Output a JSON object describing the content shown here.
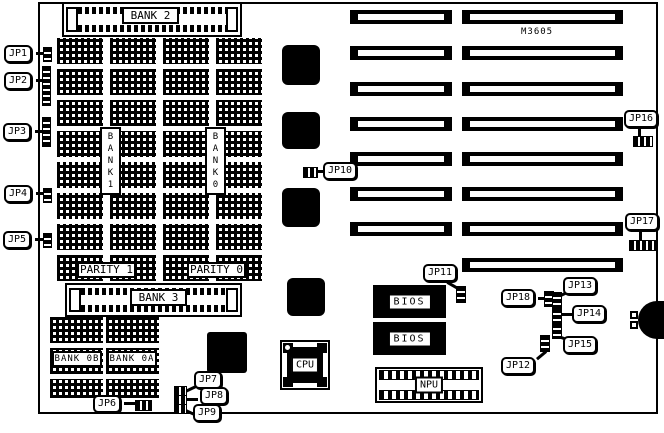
{
  "diagram": {
    "model": "M3605",
    "cpu": "CPU",
    "npu": "NPU",
    "bios_top": "BIOS",
    "bios_bottom": "BIOS",
    "bank2": "BANK 2",
    "bank3": "BANK 3",
    "bank1_vertical": "B\nA\nN\nK\n1",
    "bank0_vertical": "B\nA\nN\nK\n0",
    "parity1": "PARITY 1",
    "parity0": "PARITY 0",
    "bank0b": "BANK 0B",
    "bank0a": "BANK 0A",
    "jp1": "JP1",
    "jp2": "JP2",
    "jp3": "JP3",
    "jp4": "JP4",
    "jp5": "JP5",
    "jp6": "JP6",
    "jp7": "JP7",
    "jp8": "JP8",
    "jp9": "JP9",
    "jp10": "JP10",
    "jp11": "JP11",
    "jp12": "JP12",
    "jp13": "JP13",
    "jp14": "JP14",
    "jp15": "JP15",
    "jp16": "JP16",
    "jp17": "JP17",
    "jp18": "JP18"
  }
}
